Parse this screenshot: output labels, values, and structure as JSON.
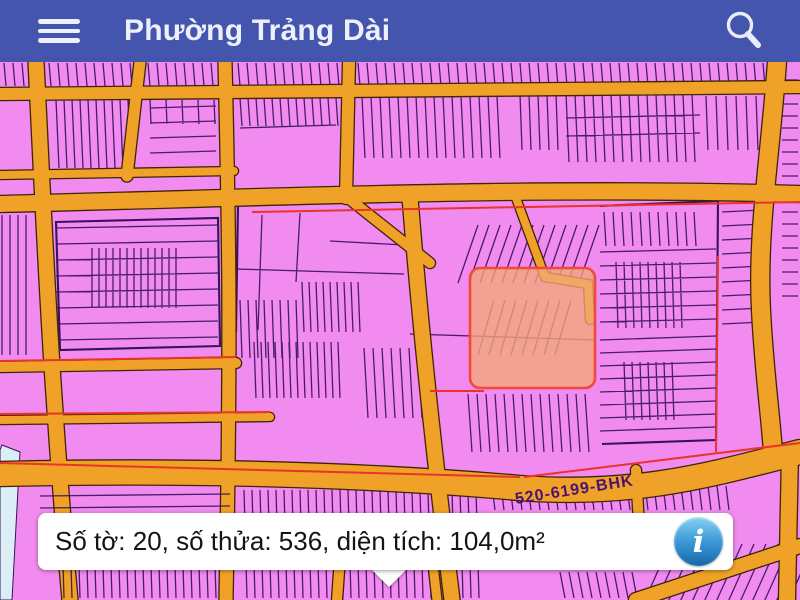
{
  "header": {
    "title": "Phường Trảng Dài"
  },
  "map": {
    "region_label": "520-6199-BHK",
    "selected_parcel": {
      "so_to": "20",
      "so_thua": "536",
      "dien_tich": "104,0m²"
    }
  },
  "info_bar": {
    "text": "Số tờ: 20, số thửa: 536, diện tích: 104,0m²",
    "icon_glyph": "i"
  },
  "theme": {
    "header-bg": "#4355AC",
    "header-fg": "#EDF0FB",
    "parcel-fill": "#F18BEF",
    "parcel-line": "#39125F",
    "road-fill": "#EFA227",
    "road-casing": "#3F2408",
    "accent-red": "#E8342A",
    "highlight-stroke": "#F4473B",
    "highlight-fill": "#F2A877",
    "water": "#DCEEF5",
    "info-icon-blue": "#2B8FD0"
  }
}
